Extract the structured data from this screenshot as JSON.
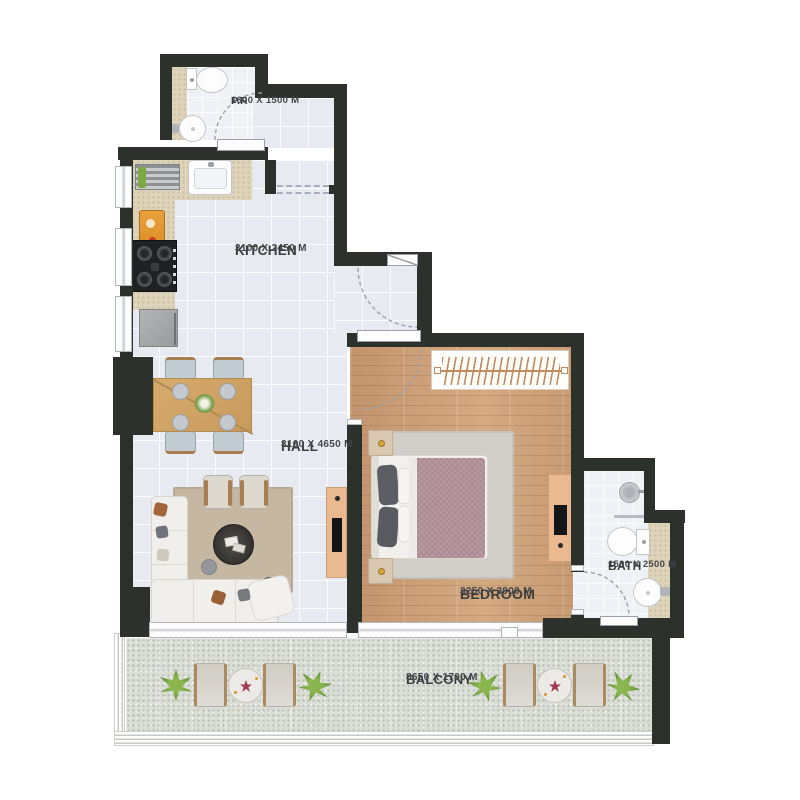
{
  "rooms": [
    {
      "name": "P.R",
      "dims": "1600 X 1500 M"
    },
    {
      "name": "KITCHEN",
      "dims": "3100 X 2450 M"
    },
    {
      "name": "HALL",
      "dims": "3100 X 4650 M"
    },
    {
      "name": "BEDROOM",
      "dims": "3250 X 3900 M"
    },
    {
      "name": "BATH",
      "dims": "1500 X 2500 M"
    },
    {
      "name": "BALCONY",
      "dims": "8650 X 1700 M"
    }
  ],
  "colors": {
    "wall": "#2c312c",
    "tile": "#e8eaf1",
    "wood": "#c99d77",
    "balcony": "#d9ddd5",
    "counter": "#ded4ba",
    "furniture_wood": "#eab98f",
    "plant": "#5d8c33",
    "blanket": "#b2929a",
    "text": "#3b3e3c"
  }
}
